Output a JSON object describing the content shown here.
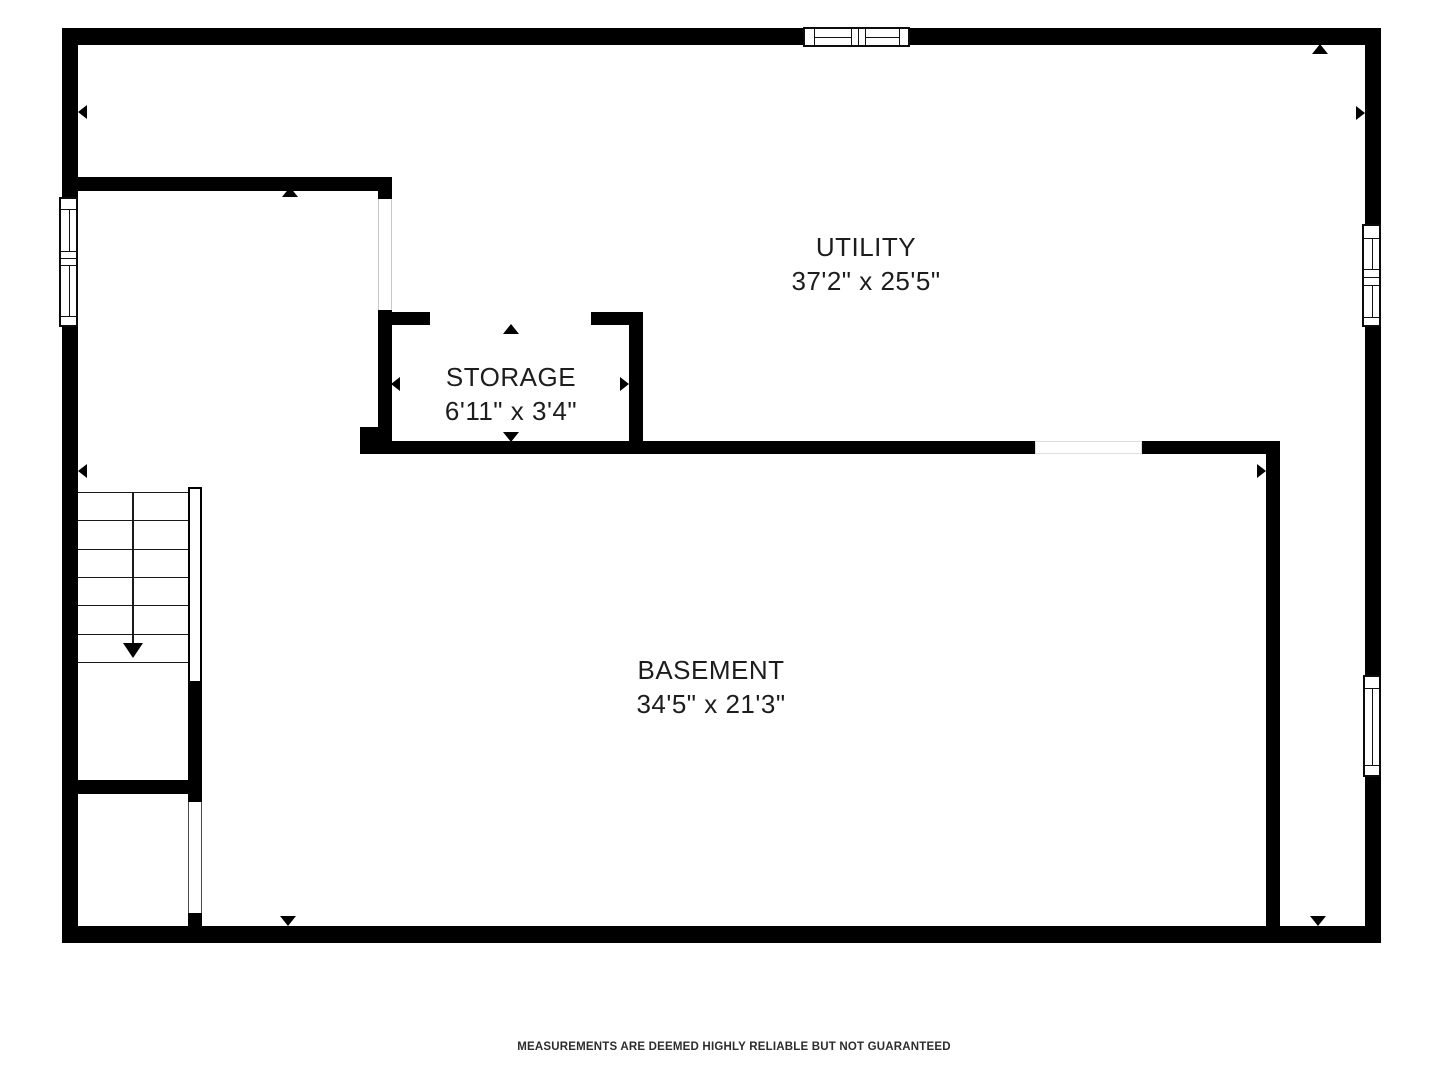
{
  "colors": {
    "background": "#ffffff",
    "walls": "#000000",
    "label_text": "#1d1d1d",
    "footer_text": "#2d2d2d"
  },
  "rooms": {
    "utility": {
      "label": "UTILITY",
      "dimensions": "37'2\" x 25'5\""
    },
    "storage": {
      "label": "STORAGE",
      "dimensions": "6'11\" x 3'4\""
    },
    "basement": {
      "label": "BASEMENT",
      "dimensions": "34'5\" x 21'3\""
    }
  },
  "footer": {
    "disclaimer": "MEASUREMENTS ARE DEEMED HIGHLY RELIABLE BUT NOT GUARANTEED"
  }
}
